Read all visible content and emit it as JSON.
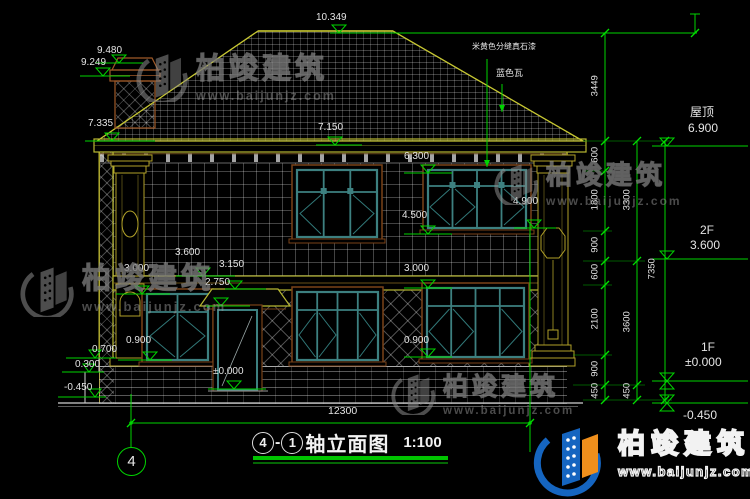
{
  "colors": {
    "dim_green": "#00d400",
    "line_yellow": "#b8b832",
    "frame_teal": "#3d8080",
    "surround_brown": "#7a4218",
    "logo_blue": "#1565c0",
    "logo_orange": "#ef8f1c"
  },
  "levels": {
    "ridge": "10.349",
    "chimney_top": "9.480",
    "chimney_cap": "9.249",
    "eave_left": "7.335",
    "eave": "7.150",
    "f2_win_top": "6.300",
    "f2_win_sill": "4.500",
    "f2_win_sill_r": "4.900",
    "f2_floor": "3.600",
    "canopy_top": "3.150",
    "canopy_btm": "2.750",
    "f1_win_top_l": "3.000",
    "f1_win_top_r": "3.000",
    "f1_win_sill_l": "0.900",
    "f1_win_sill_r": "0.900",
    "f1_floor": "±0.000",
    "step_top": "0.700",
    "step_mid": "0.300",
    "ground": "-0.450"
  },
  "callouts": {
    "roof_name": "屋顶",
    "roof_level": "6.900",
    "f2_name": "2F",
    "f2_level": "3.600",
    "f1_name": "1F",
    "f1_level": "±0.000",
    "ground_level": "-0.450"
  },
  "chains": {
    "a": [
      "3449",
      "600",
      "1800",
      "900",
      "600",
      "2100",
      "900",
      "450"
    ],
    "b": [
      "3300",
      "3600",
      "450"
    ],
    "c": [
      "7350"
    ],
    "width": "12300"
  },
  "notes": {
    "wall_finish": "米黄色分缝真石漆",
    "roof_tile": "蓝色瓦"
  },
  "title": {
    "axis_start": "4",
    "dash": "-",
    "axis_end": "1",
    "name": "轴立面图",
    "scale": "1:100"
  },
  "axis": {
    "bubble": "4"
  },
  "watermark": {
    "brand": "柏竣建筑",
    "url": "www.baijunjz.com"
  }
}
